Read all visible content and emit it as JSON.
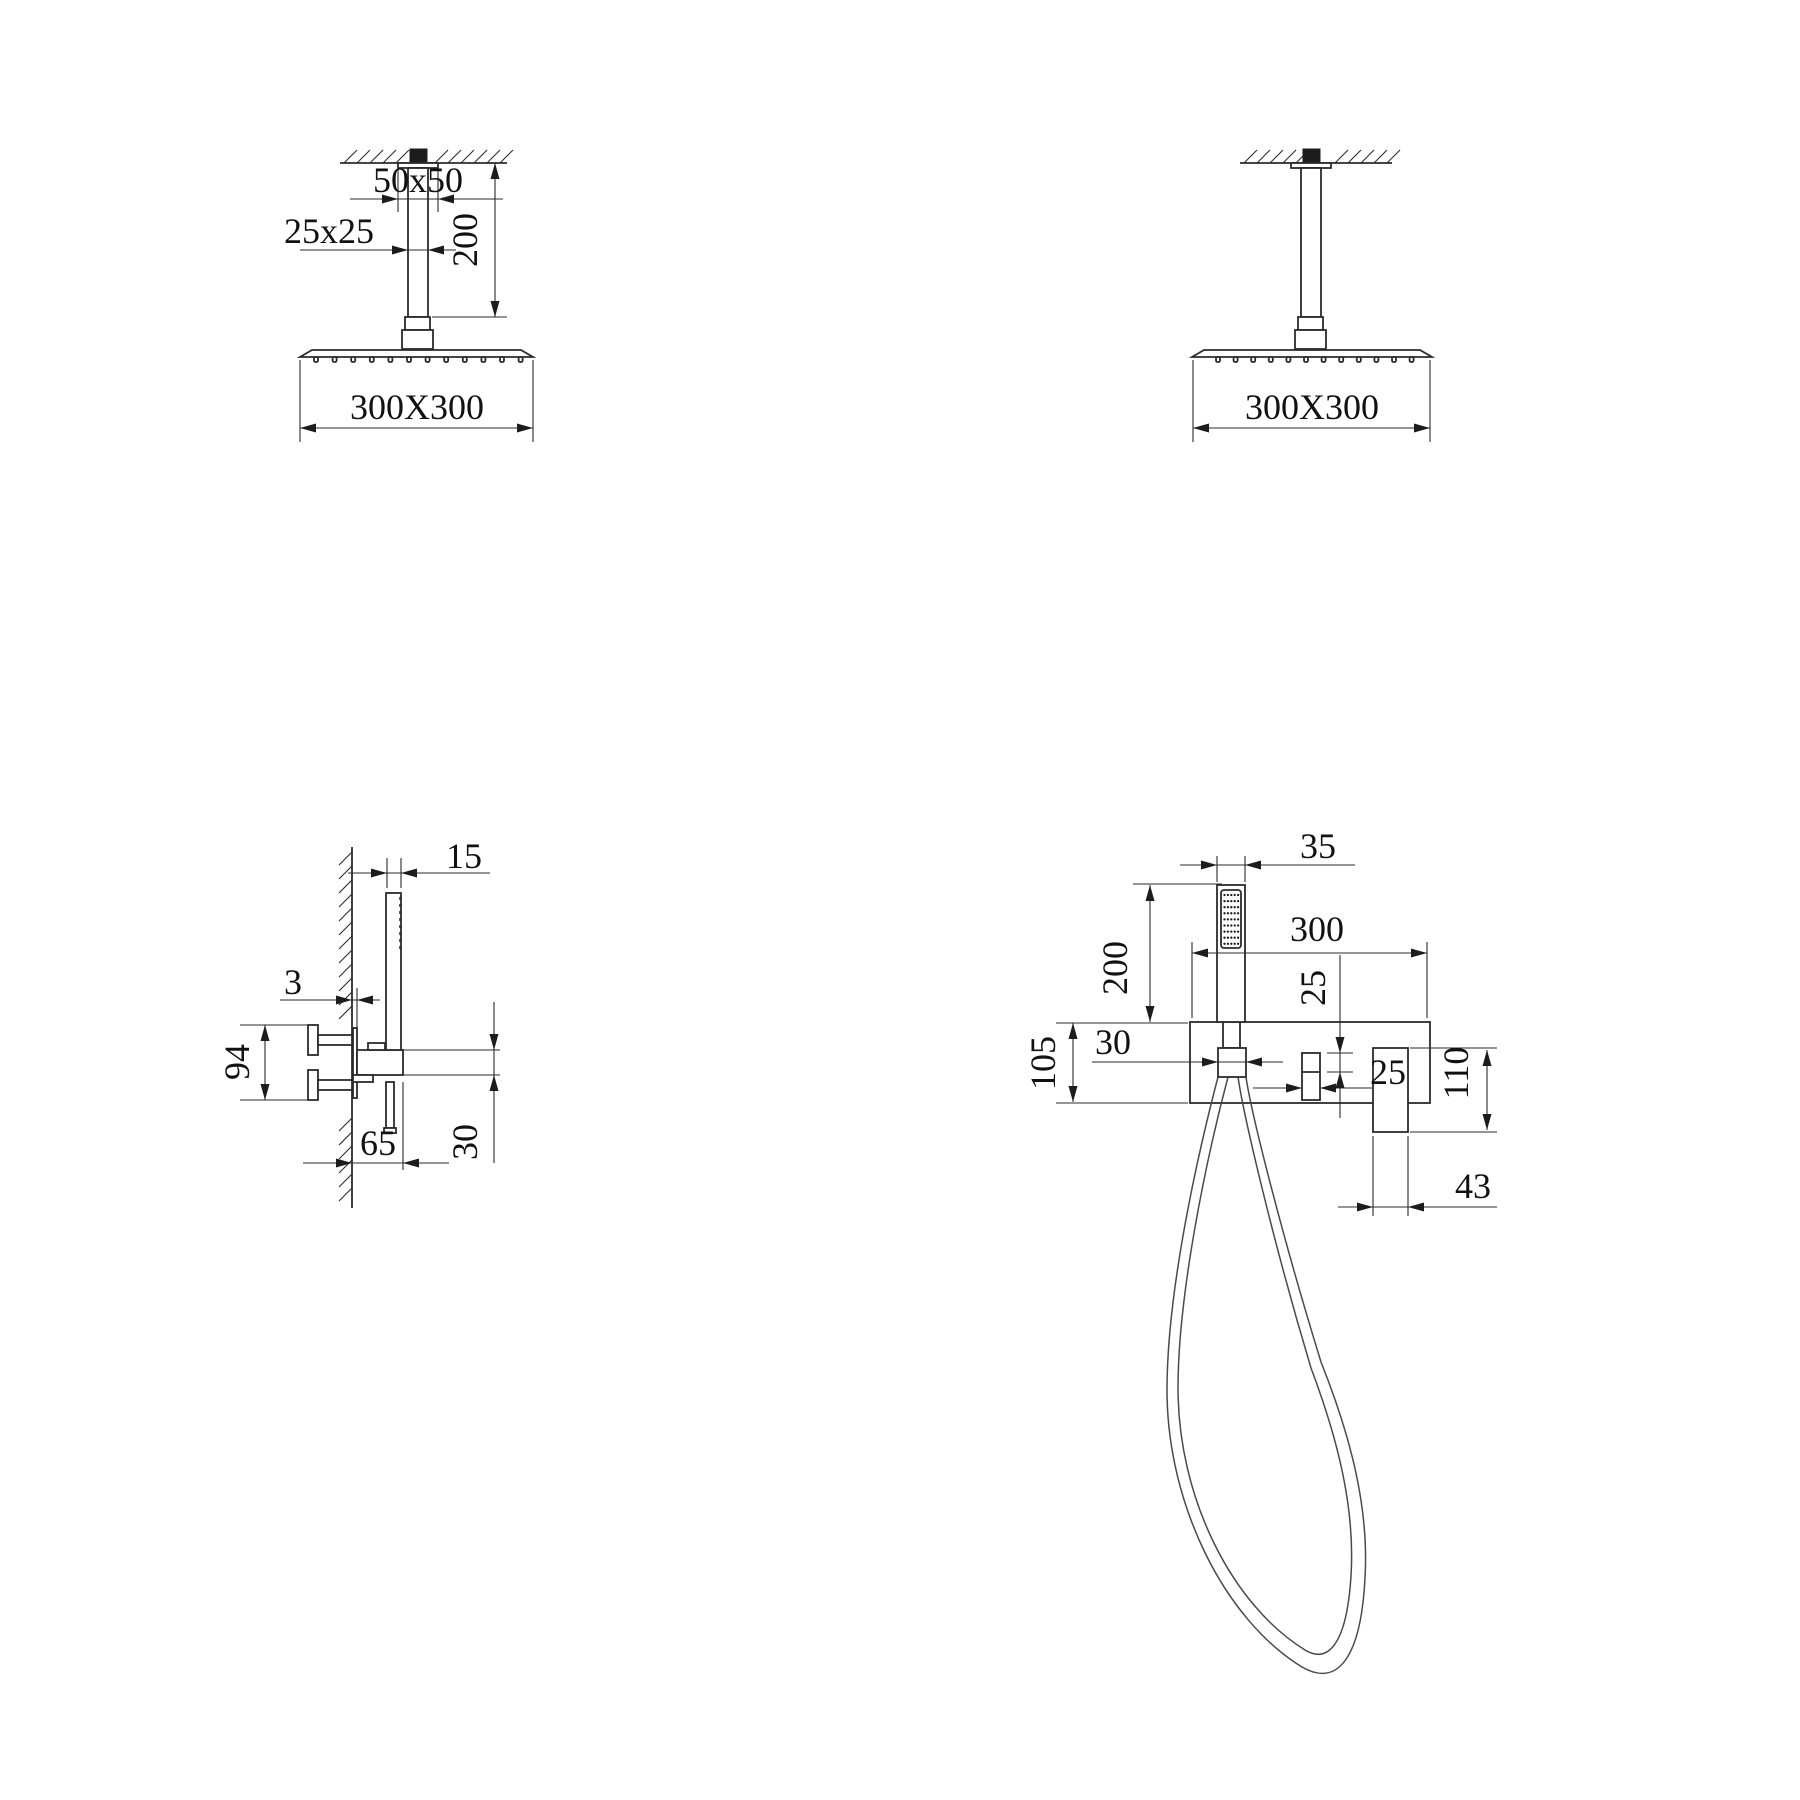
{
  "title": "Shower system installation dimension drawing",
  "colors": {
    "background": "#ffffff",
    "line": "#2b2b2b",
    "text": "#111111"
  },
  "figures": {
    "ceiling_shower_left": {
      "name": "ceiling rain shower head side view with arm dimensions",
      "dims": {
        "flange_size": "50x50",
        "arm_size": "25x25",
        "arm_length": "200",
        "head_size": "300X300"
      }
    },
    "ceiling_shower_right": {
      "name": "ceiling rain shower head front view",
      "dims": {
        "head_size": "300X300"
      }
    },
    "hand_shower_side": {
      "name": "wall mixer with hand shower side view",
      "dims": {
        "wand_width": "15",
        "wall_gap": "3",
        "valve_height": "94",
        "spout_depth": "65",
        "spout_height": "30"
      }
    },
    "hand_shower_front": {
      "name": "wall mixer with hand shower front view",
      "dims": {
        "wand_width": "35",
        "wand_height": "200",
        "plate_width": "300",
        "knob_offset": "25",
        "holder_width": "30",
        "plate_height": "105",
        "knob_width": "25",
        "handle_height": "110",
        "handle_width": "43"
      }
    }
  }
}
